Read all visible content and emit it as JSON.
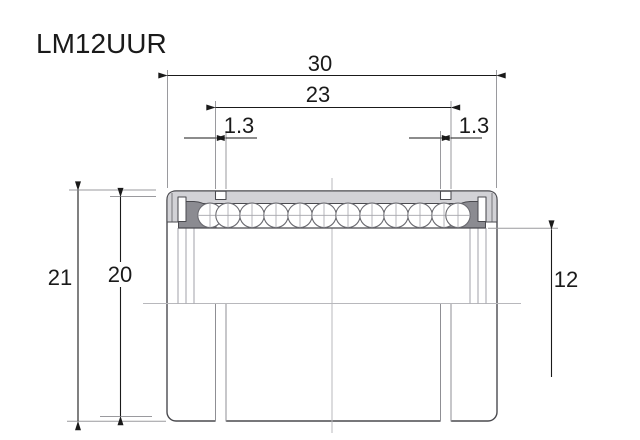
{
  "title": "LM12UUR",
  "dimensions": {
    "outer_length": "30",
    "groove_spacing": "23",
    "groove_width_left": "1.3",
    "groove_width_right": "1.3",
    "outer_diameter": "21",
    "sleeve_outer_diameter": "20",
    "bore_diameter": "12"
  },
  "colors": {
    "dim": "#1a1a1a",
    "outline": "#4a4a4f",
    "shell": "#d2d2d6",
    "seal": "#8b8b91",
    "ballStroke": "#6b6b71",
    "crosshair": "#a4a4aa",
    "extline": "#9a9a9e",
    "centerline": "#b8b8bc",
    "midline": "#a2a2a8",
    "grooveline": "#8f8f94"
  }
}
